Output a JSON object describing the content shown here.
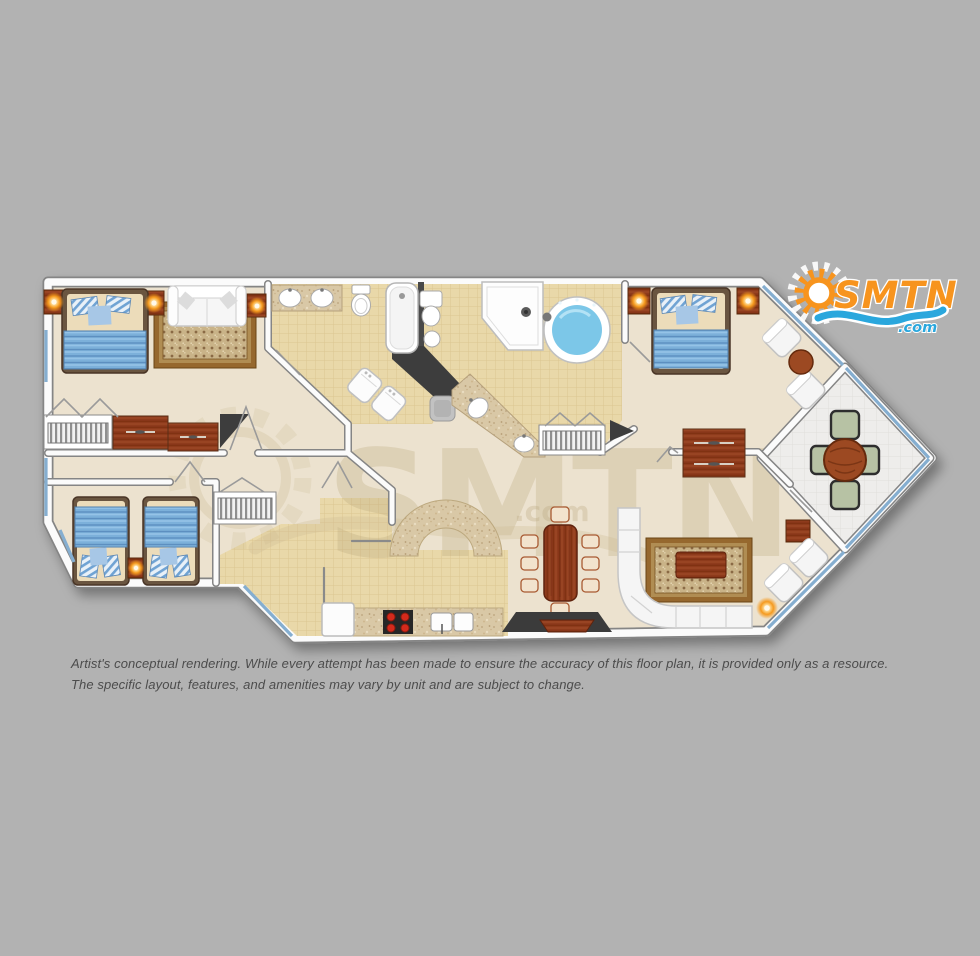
{
  "page": {
    "background": "#b2b2b2"
  },
  "logo": {
    "brand": "SMTN",
    "tld": ".com",
    "orange": "#f7941e",
    "blue": "#2aa7dd"
  },
  "watermark": {
    "brand": "SMTN",
    "tld": ".com",
    "tint": "#b3a176"
  },
  "disclaimer": {
    "line1": "Artist's conceptual rendering. While every attempt has been made to ensure the accuracy of this floor plan, it is provided only as a resource.",
    "line2": "The specific layout, features, and amenities may vary by unit and are subject to change."
  },
  "floorplan": {
    "colors": {
      "floor": "#ece2cf",
      "tile_base": "#e9d8a9",
      "tile_line": "#dcc691",
      "wall_fill": "#fbfbfb",
      "wall_edge": "#858585",
      "dark_wall": "#3e3e3e",
      "wood_base": "#8e3b1a",
      "bed_blue": "#7cb0da",
      "jacuzzi_water": "#7cc7e8",
      "balcony_floor": "#eeedeb",
      "rail_blue": "#85aed0",
      "granite_base": "#d9c8a6",
      "rug_border": "#96682f",
      "lamp_glow": "#f7941e",
      "stove_burner": "#d42b1f"
    }
  }
}
